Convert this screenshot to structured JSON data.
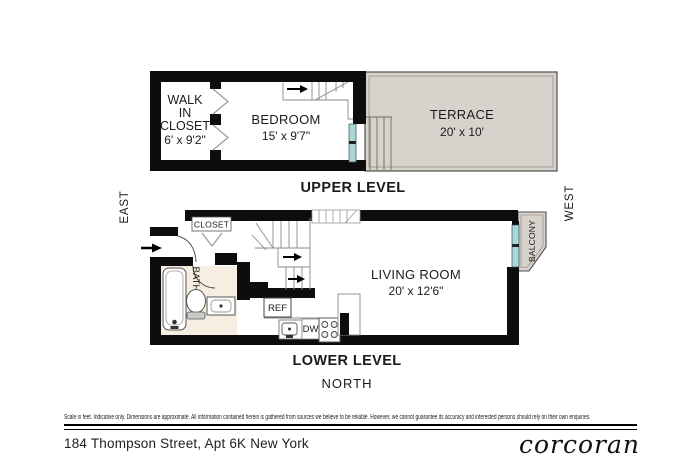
{
  "footer": {
    "disclaimer": "Scale in feet. Indicative only. Dimensions are approximate. All information contained herein is gathered from sources we believe to be reliable. However, we cannot guarantee its accuracy and interested persons should rely on their own enquiries.",
    "address": "184 Thompson Street, Apt 6K New York",
    "brand": "corcoran"
  },
  "compass": {
    "east": "EAST",
    "west": "WEST",
    "north": "NORTH"
  },
  "upper": {
    "title": "UPPER LEVEL",
    "walk_in_closet": {
      "lines": [
        "WALK",
        "IN",
        "CLOSET"
      ],
      "dims": "6' x 9'2\""
    },
    "bedroom": {
      "name": "BEDROOM",
      "dims": "15' x 9'7\""
    },
    "terrace": {
      "name": "TERRACE",
      "dims": "20' x 10'"
    }
  },
  "lower": {
    "title": "LOWER LEVEL",
    "living_room": {
      "name": "LIVING ROOM",
      "dims": "20' x 12'6\""
    },
    "closet": "CLOSET",
    "bath": "BATH",
    "balcony": "BALCONY",
    "ref": "REF",
    "dw": "DW"
  },
  "colors": {
    "wall": "#0d0d0d",
    "outdoor_fill": "#d8d2cc",
    "glazing": "#a9d8da",
    "bath_tile": "#f6efe1"
  }
}
